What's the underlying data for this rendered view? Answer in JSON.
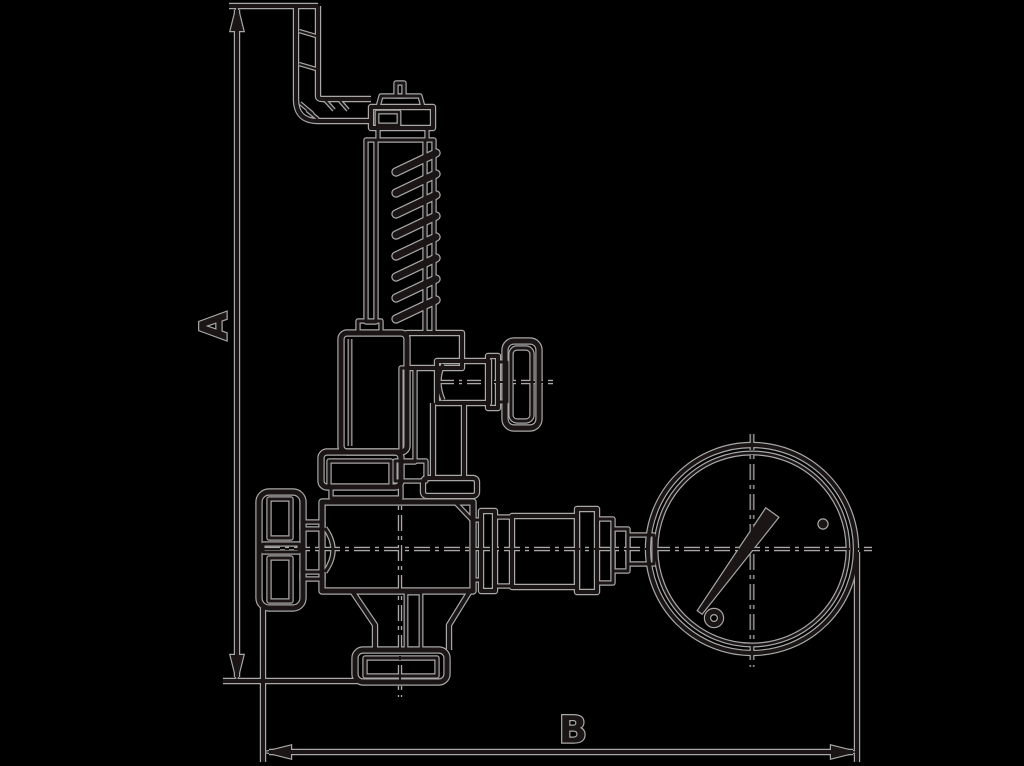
{
  "figure": {
    "type": "technical-drawing",
    "subject": "safety-relief-valve-with-pressure-gauge",
    "background_color": "#000000",
    "ink_color": "#1b1516",
    "halo_color": "#a8a8a8",
    "labels": {
      "dim_a": "A",
      "dim_b": "B"
    }
  }
}
